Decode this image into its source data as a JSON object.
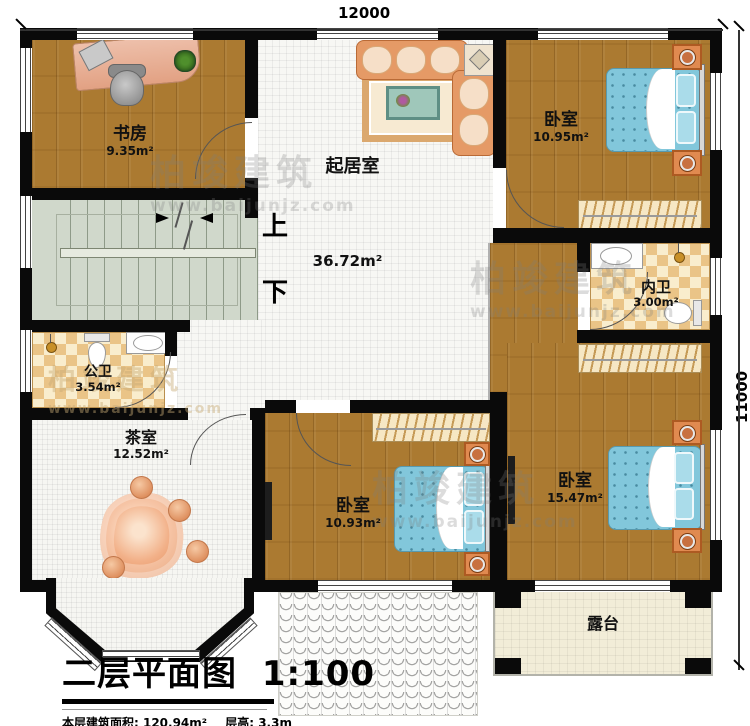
{
  "dimensions": {
    "top": "12000",
    "right": "11000"
  },
  "rooms": {
    "study": {
      "name": "书房",
      "area": "9.35m²"
    },
    "living": {
      "name": "起居室",
      "area": "36.72m²"
    },
    "bedroom1": {
      "name": "卧室",
      "area": "10.95m²"
    },
    "inner_bath": {
      "name": "内卫",
      "area": "3.00m²"
    },
    "public_bath": {
      "name": "公卫",
      "area": "3.54m²"
    },
    "tea_room": {
      "name": "茶室",
      "area": "12.52m²"
    },
    "bedroom2": {
      "name": "卧室",
      "area": "10.93m²"
    },
    "bedroom3": {
      "name": "卧室",
      "area": "15.47m²"
    },
    "terrace": {
      "name": "露台"
    }
  },
  "stairs": {
    "up": "上",
    "down": "下"
  },
  "title": {
    "plan_name": "二层平面图",
    "scale": "1:100",
    "floor_area_label": "本层建筑面积: 120.94m²",
    "floor_height_label": "层高: 3.3m"
  },
  "watermark": {
    "brand": "柏竣建筑",
    "url": "www.baijunjz.com"
  },
  "colors": {
    "wall": "#0a0a0a",
    "wood_floor": "#ab7a31",
    "tile_floor": "#f7f7f4",
    "stair_floor": "#d0d8cb",
    "checker_dark": "#eac487",
    "checker_light": "#f9edcd",
    "bed_blue": "#82c7db",
    "nightstand_orange": "#e08a50",
    "terrace_floor": "#f2edd8"
  }
}
